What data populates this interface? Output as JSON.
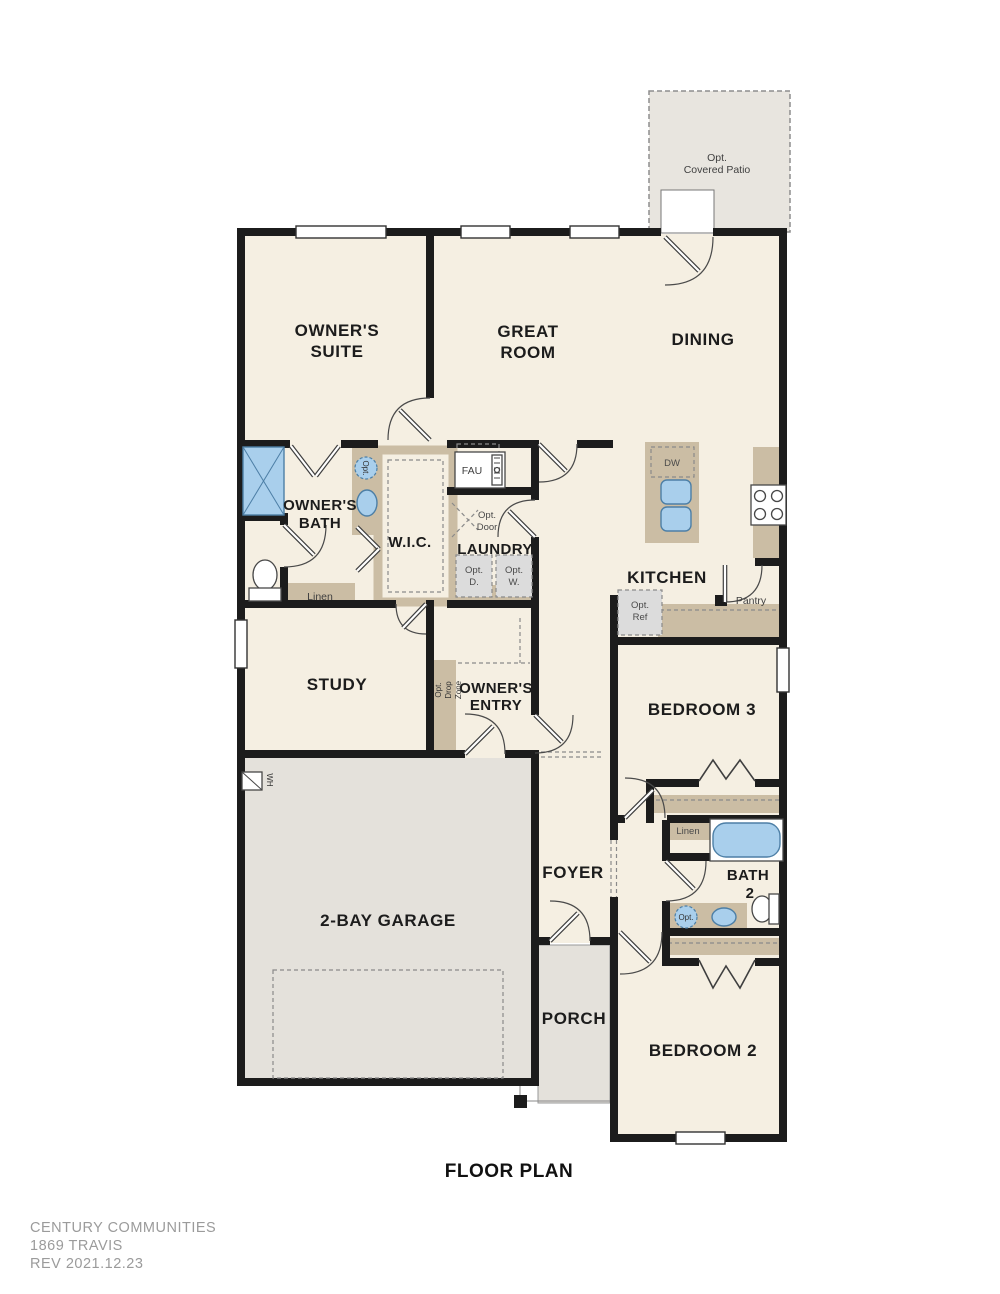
{
  "title": {
    "floor_plan": "FLOOR PLAN"
  },
  "footer": {
    "company": "CENTURY COMMUNITIES",
    "model": "1869 TRAVIS",
    "revision": "REV 2021.12.23"
  },
  "rooms": {
    "owners_suite_1": "OWNER'S",
    "owners_suite_2": "SUITE",
    "great_room_1": "GREAT",
    "great_room_2": "ROOM",
    "dining": "DINING",
    "owners_bath_1": "OWNER'S",
    "owners_bath_2": "BATH",
    "wic": "W.I.C.",
    "laundry": "LAUNDRY",
    "kitchen": "KITCHEN",
    "study": "STUDY",
    "owners_entry_1": "OWNER'S",
    "owners_entry_2": "ENTRY",
    "bedroom3": "BEDROOM 3",
    "garage": "2-BAY GARAGE",
    "foyer": "FOYER",
    "bath2_1": "BATH",
    "bath2_2": "2",
    "porch": "PORCH",
    "bedroom2": "BEDROOM 2",
    "patio_1": "Opt.",
    "patio_2": "Covered Patio"
  },
  "features": {
    "linen_owner": "Linen",
    "linen_bath2": "Linen",
    "pantry": "Pantry",
    "fau": "FAU",
    "dw": "DW",
    "wh": "WH",
    "opt_ref_1": "Opt.",
    "opt_ref_2": "Ref",
    "opt_dryer_1": "Opt.",
    "opt_dryer_2": "D.",
    "opt_washer_1": "Opt.",
    "opt_washer_2": "W.",
    "opt_door_1": "Opt.",
    "opt_door_2": "Door",
    "opt_drop_1": "Opt.",
    "opt_drop_2": "Drop",
    "opt_drop_3": "Zone",
    "opt_toilet": "Opt.",
    "opt_sink": "Opt."
  },
  "colors": {
    "room_fill": "#f5efe2",
    "garage_fill": "#e4e1db",
    "patio_fill": "#e8e5df",
    "cabinet_tan": "#cbbda4",
    "fixture_blue": "#a9cfec",
    "wall": "#1c1c1c",
    "footer_text": "#9b9b9b"
  }
}
